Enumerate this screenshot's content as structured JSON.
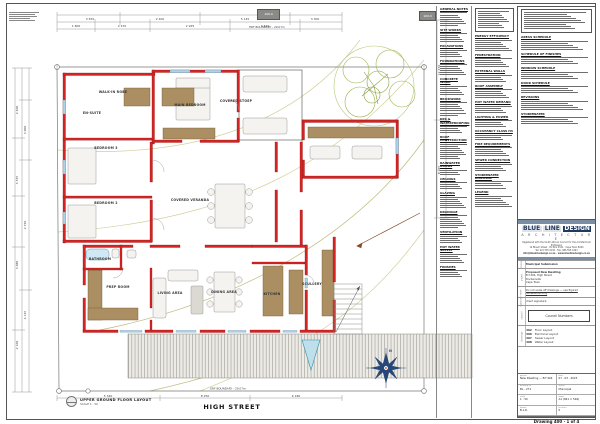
{
  "sheet": {
    "view_title": "UPPER GROUND FLOOR LAYOUT",
    "view_scale": "SCALE 1 : 50",
    "street_label": "HIGH STREET"
  },
  "plan": {
    "boundary_top": "ERF BOUNDARY  -  29.07m",
    "boundary_bottom": "ERF BOUNDARY  -  29.07m",
    "level_markers": [
      "100.0",
      "100.0"
    ],
    "rooms": [
      {
        "name": "WALK-IN ROBE",
        "x": 113,
        "y": 92
      },
      {
        "name": "EN-SUITE",
        "x": 92,
        "y": 113
      },
      {
        "name": "MAIN BEDROOM",
        "x": 190,
        "y": 105
      },
      {
        "name": "COVERED STOEP",
        "x": 236,
        "y": 101
      },
      {
        "name": "BEDROOM 3",
        "x": 106,
        "y": 148
      },
      {
        "name": "BEDROOM 2",
        "x": 106,
        "y": 203
      },
      {
        "name": "COVERED VERANDA",
        "x": 190,
        "y": 200
      },
      {
        "name": "BATHROOM",
        "x": 100,
        "y": 259
      },
      {
        "name": "PREP ROOM",
        "x": 118,
        "y": 287
      },
      {
        "name": "LIVING AREA",
        "x": 170,
        "y": 293
      },
      {
        "name": "DINING AREA",
        "x": 224,
        "y": 292
      },
      {
        "name": "KITCHEN",
        "x": 272,
        "y": 294
      },
      {
        "name": "SCULLERY",
        "x": 312,
        "y": 284
      }
    ],
    "dims_top": [
      "3 870",
      "2 400",
      "5 145",
      "3 300"
    ],
    "dims_top2": [
      "1 800",
      "4 470",
      "2 925",
      "3 520"
    ],
    "dims_left": [
      "2 400",
      "4 535",
      "3 680",
      "2 100"
    ],
    "dims_left2": [
      "3 900",
      "2 740",
      "4 125"
    ],
    "dims_bottom": [
      "5 340",
      "8 250",
      "6 180"
    ],
    "dims_right": [
      "12 470",
      "8 925"
    ],
    "north_label": "N"
  },
  "notes": {
    "colA": {
      "sections": [
        {
          "h": "GENERAL NOTES",
          "n": 7
        },
        {
          "h": "SITE WORKS",
          "n": 5
        },
        {
          "h": "EXCAVATIONS",
          "n": 4
        },
        {
          "h": "FOUNDATIONS",
          "n": 6
        },
        {
          "h": "CONCRETE WORK",
          "n": 5
        },
        {
          "h": "BRICKWORK",
          "n": 7
        },
        {
          "h": "DPC & WATERPROOFING",
          "n": 4
        },
        {
          "h": "ROOF CONSTRUCTION",
          "n": 8
        },
        {
          "h": "RAINWATER GOODS",
          "n": 3
        },
        {
          "h": "CEILINGS",
          "n": 4
        },
        {
          "h": "GLAZING",
          "n": 6
        },
        {
          "h": "DRAINAGE",
          "n": 7
        },
        {
          "h": "VENTILATION",
          "n": 4
        },
        {
          "h": "HOT WATER SUPPLY",
          "n": 5
        },
        {
          "h": "FINISHES",
          "n": 4
        }
      ]
    },
    "colB": {
      "sections": [
        {
          "h": "",
          "n": 9,
          "b": true
        },
        {
          "h": "ENERGY EFFICIENCY",
          "n": 6
        },
        {
          "h": "FENESTRATION",
          "n": 5
        },
        {
          "h": "EXTERNAL WALLS",
          "n": 4
        },
        {
          "h": "ROOF ASSEMBLY",
          "n": 5
        },
        {
          "h": "HOT WATER DEMAND",
          "n": 4
        },
        {
          "h": "LIGHTING & POWER",
          "n": 4
        },
        {
          "h": "OCCUPANCY CLASS H4",
          "n": 3
        },
        {
          "h": "FIRE REQUIREMENTS",
          "n": 5
        },
        {
          "h": "SEWER CONNECTION",
          "n": 4
        },
        {
          "h": "STORMWATER DISPOSAL",
          "n": 4
        },
        {
          "h": "LEGEND",
          "n": 6
        }
      ]
    },
    "colC": {
      "sections": [
        {
          "h": "",
          "n": 9,
          "b": true
        },
        {
          "h": "AREAS SCHEDULE",
          "n": 5
        },
        {
          "h": "SCHEDULE OF FINISHES",
          "n": 4
        },
        {
          "h": "WINDOW SCHEDULE",
          "n": 4
        },
        {
          "h": "DOOR SCHEDULE",
          "n": 4
        },
        {
          "h": "REVISIONS",
          "n": 5
        },
        {
          "h": "STORMWATER",
          "n": 4
        }
      ]
    }
  },
  "titleblock": {
    "brand_word1": "BLUE",
    "brand_word2": "LINE",
    "brand_word3": "DESIGN",
    "brand_line2": "A R C H I T E C T U R E",
    "address_lines": [
      "Registered with the South African Council for the Architectural Profession",
      "14 Bloem Street  ·  PO Box 4521  ·  Cape Town  8000",
      "Tel: 021 555 0192  ·  Fax: 086 555 0193"
    ],
    "contact_line": "info@bluelinedesign.co.za  ·  www.bluelinedesign.co.za",
    "status_label": "status",
    "status_value": "Municipal Submission",
    "project_label": "project",
    "project_lines": [
      "Proposed New Dwelling",
      "Erf 404, High Street",
      "Durbanville",
      "Cape Town"
    ],
    "notes_label": "notes",
    "notes_value": "Do not scale off drawings — use figured dimensions only",
    "signature_label": "signature",
    "signature_value": "client signature:",
    "council_label": "council",
    "council_box": "Council Numbers",
    "drawings_label": "drawings",
    "drawing_list": [
      {
        "no": "402",
        "label": "Floor Layout"
      },
      {
        "no": "406",
        "label": "Electrical Layout"
      },
      {
        "no": "407",
        "label": "Sewer Layout"
      },
      {
        "no": "408",
        "label": "Water Layout"
      }
    ],
    "info_cells": [
      {
        "label": "project",
        "value": "New Dwelling — Erf 404"
      },
      {
        "label": "date",
        "value": "07 . 03 . 2023"
      },
      {
        "label": "drawing no",
        "value": "BL - 271"
      },
      {
        "label": "status",
        "value": "Municipal"
      },
      {
        "label": "scale",
        "value": "1 : 50"
      },
      {
        "label": "paper",
        "value": "A1 (841 × 594)"
      },
      {
        "label": "drawn",
        "value": "B.L.D."
      },
      {
        "label": "revision",
        "value": "0"
      }
    ],
    "footer": "Drawing 400  ·  1 of 4"
  }
}
